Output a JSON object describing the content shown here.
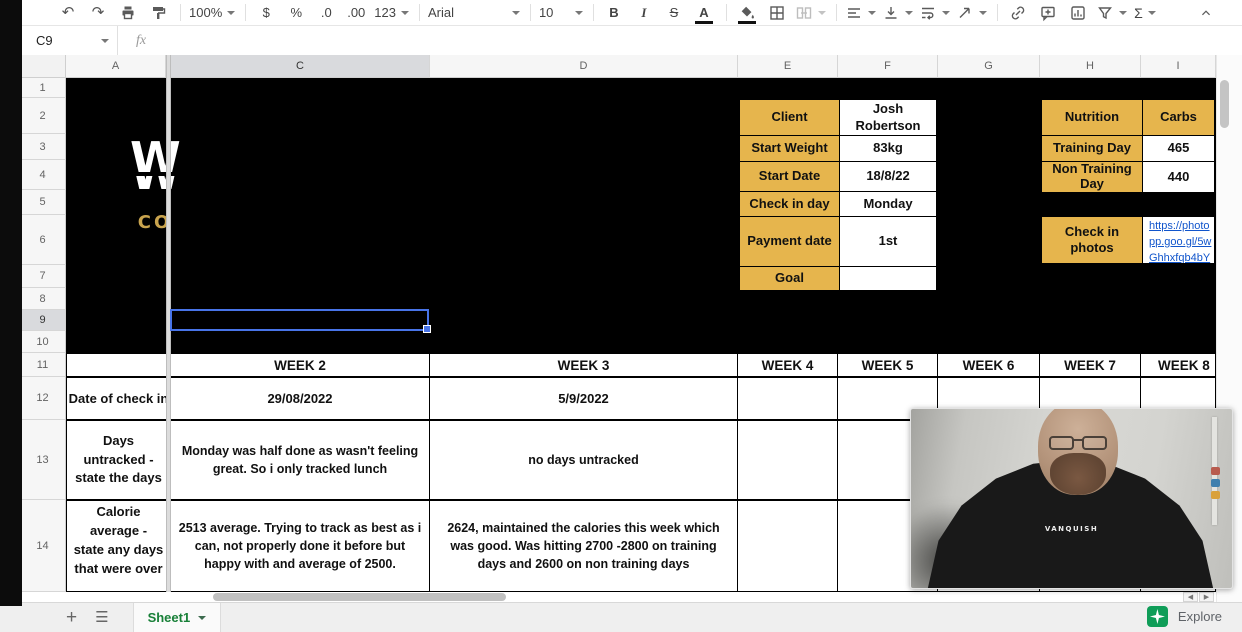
{
  "colors": {
    "gold": "#e6b54d",
    "selection": "#4874e8",
    "link": "#1155cc",
    "sheet_green": "#188038",
    "explore_green": "#0f9d58"
  },
  "toolbar": {
    "zoom": "100%",
    "currency": "$",
    "percent": "%",
    "decimal_decrease": ".0",
    "decimal_increase": ".00",
    "more_formats": "123",
    "font": "Arial",
    "font_size": "10",
    "bold": "B",
    "italic": "I",
    "strikethrough": "S",
    "text_color": "A",
    "functions": "Σ"
  },
  "formula_bar": {
    "cell_ref": "C9",
    "fx": "fx"
  },
  "grid": {
    "columns": [
      "A",
      "C",
      "D",
      "E",
      "F",
      "G",
      "H",
      "I"
    ],
    "rows": [
      "1",
      "2",
      "3",
      "4",
      "5",
      "6",
      "7",
      "8",
      "9",
      "10",
      "11",
      "12",
      "13",
      "14"
    ],
    "selected_cell": "C9"
  },
  "logo": {
    "co": "CO",
    "w": "W"
  },
  "client_table": {
    "rows": [
      {
        "label": "Client",
        "value": "Josh Robertson"
      },
      {
        "label": "Start Weight",
        "value": "83kg"
      },
      {
        "label": "Start Date",
        "value": "18/8/22"
      },
      {
        "label": "Check in day",
        "value": "Monday"
      },
      {
        "label": "Payment date",
        "value": "1st"
      },
      {
        "label": "Goal",
        "value": ""
      }
    ]
  },
  "nutrition_table": {
    "header_col1": "Nutrition",
    "header_col2": "Carbs",
    "rows": [
      {
        "label": "Training Day",
        "value": "465"
      },
      {
        "label": "Non Training Day",
        "value": "440"
      }
    ]
  },
  "photos": {
    "label": "Check in photos",
    "link_line1": "https://photo",
    "link_line2": "pp.goo.gl/5w",
    "link_line3": "Ghhxfqb4bY"
  },
  "weeks": [
    "WEEK 2",
    "WEEK 3",
    "WEEK 4",
    "WEEK 5",
    "WEEK 6",
    "WEEK 7",
    "WEEK 8"
  ],
  "data_rows": {
    "date": {
      "label": "Date of check in",
      "week2": "29/08/2022",
      "week3": "5/9/2022"
    },
    "untracked": {
      "label": "Days untracked - state the days",
      "week2": "Monday was half done as wasn't feeling great. So i only tracked lunch",
      "week3": "no days untracked"
    },
    "calories": {
      "label": "Calorie average - state any days that were over",
      "week2": "2513 average. Trying to track as best as i can, not properly done it before but happy with and average of 2500.",
      "week3": "2624, maintained the calories this week which was good. Was hitting 2700 -2800 on training days and 2600 on non training days"
    }
  },
  "webcam": {
    "shirt_text": "VANQUISH"
  },
  "sheet_bar": {
    "tab": "Sheet1",
    "explore": "Explore"
  }
}
